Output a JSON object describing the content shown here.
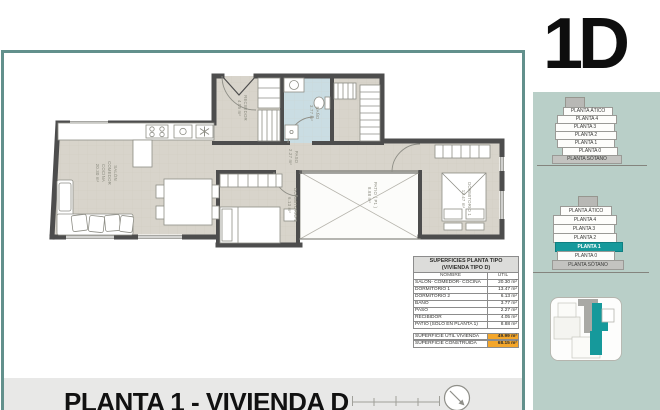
{
  "unit_code": "1D",
  "footer": {
    "title": "PLANTA 1 - VIVIENDA D"
  },
  "surface_table": {
    "title_line1": "SUPERFICIES PLANTA TIPO",
    "title_line2": "(VIVIENDA TIPO D)",
    "col_name": "NOMBRE",
    "col_util": "ÚTIL",
    "rows": [
      {
        "name": "SALÓN- COMEDOR- COCINA",
        "util": "20.30 m²"
      },
      {
        "name": "DORMITORIO 1",
        "util": "13.47 m²"
      },
      {
        "name": "DORMITORIO 2",
        "util": "6.13 m²"
      },
      {
        "name": "BAÑO",
        "util": "3.77 m²"
      },
      {
        "name": "PASO",
        "util": "2.27 m²"
      },
      {
        "name": "RECIBIDOR",
        "util": "4.05 m²"
      },
      {
        "name": "PATIO (SOLO EN PLANTA 1)",
        "util": "8.88 m²"
      }
    ],
    "totals": [
      {
        "name": "SUPERFICIE ÚTIL VIVIENDA",
        "util": "49.99 m²"
      },
      {
        "name": "SUPERFICIE CONSTRUIDA",
        "util": "68.15 m²"
      }
    ]
  },
  "floor_stacks": {
    "stack_overview": {
      "floors": [
        "PLANTA ÁTICO",
        "PLANTA 4",
        "PLANTA 3",
        "PLANTA 2",
        "PLANTA 1",
        "PLANTA 0",
        "PLANTA SÓTANO"
      ]
    },
    "stack_highlight": {
      "floors": [
        "PLANTA ÁTICO",
        "PLANTA 4",
        "PLANTA 3",
        "PLANTA 2",
        "PLANTA 1",
        "PLANTA 0",
        "PLANTA SÓTANO"
      ],
      "highlighted": "PLANTA 1"
    }
  },
  "rooms": {
    "salon": {
      "line1": "SALÓN",
      "line2": "COMEDOR",
      "line3": "COCINA",
      "area": "20.30 m²"
    },
    "recibidor": {
      "name": "RECIBIDOR",
      "area": "4.05 m²"
    },
    "bano": {
      "name": "BAÑO",
      "area": "3.77 m²"
    },
    "paso": {
      "name": "PASO",
      "area": "2.27 m²"
    },
    "dormitorio2": {
      "name": "DORMITORIO 2",
      "area": "6.13 m²"
    },
    "patio": {
      "name": "PATIO ( P1 )",
      "area": "8.88 m²"
    },
    "dormitorio1": {
      "name": "DORMITORIO 1",
      "area": "13.47 m²"
    }
  },
  "colors": {
    "accent_teal": "#16999b",
    "panel_sage": "#b9cfc8",
    "highlight_orange": "#f4a62a",
    "wall": "#4d4d4d",
    "floor": "#d8d4cb",
    "bath_floor": "#cadde3",
    "frame_border": "#62908c"
  }
}
